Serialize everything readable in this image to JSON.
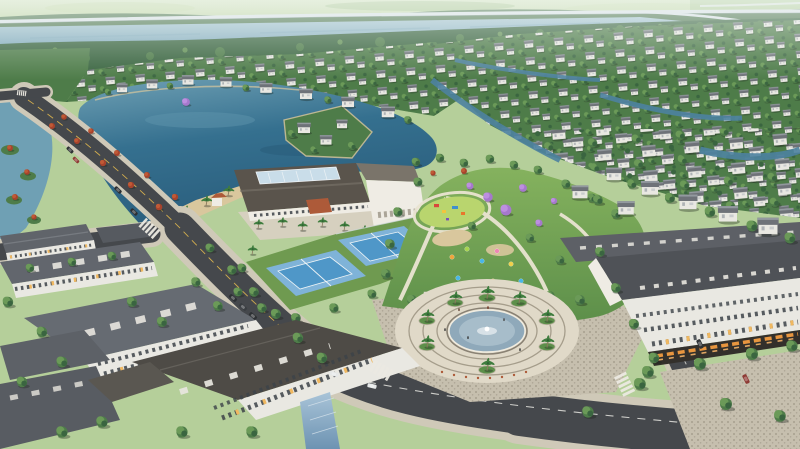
{
  "meta": {
    "type": "aerial-3d-render",
    "subject": "lakeside master-planned residential community, bird's-eye view",
    "width_px": 800,
    "height_px": 449
  },
  "scene": {
    "landmarks": [
      {
        "name": "river-and-elevated-highway",
        "position": "top edge"
      },
      {
        "name": "villa-field",
        "position": "upper half, white villas with grey roofs among trees and canals"
      },
      {
        "name": "central-lake",
        "position": "upper left-center, deep teal water"
      },
      {
        "name": "causeway-road",
        "position": "diagonal from top-left, lined with red flame trees"
      },
      {
        "name": "clubhouse",
        "position": "center, long white building with dark roof and glass skylight"
      },
      {
        "name": "tennis-courts",
        "count": 2,
        "position": "below clubhouse, blue courts on green apron"
      },
      {
        "name": "central-park",
        "position": "center-right, lawns, playground, purple jacaranda trees, balloons"
      },
      {
        "name": "fountain-plaza",
        "position": "lower center, circular paved plaza with fountain pool and palms"
      },
      {
        "name": "townhouse-blocks",
        "position": "lower left foreground, white facades, slate roofs, lit windows"
      },
      {
        "name": "shophouse-row",
        "position": "lower right, orange-lit storefronts"
      },
      {
        "name": "roads",
        "details": "asphalt streets with zebra crosswalks, lane dashes, cars"
      }
    ],
    "counts": {
      "tennis_courts": 2,
      "crosswalks": 4,
      "cars_visible": 11,
      "balloons": 10
    }
  },
  "palette": {
    "fieldLight": "#d8e6c0",
    "fieldMid": "#b2cd96",
    "fieldDark": "#9abc82",
    "bridge": "#dde4e9",
    "bridgeShadow": "#a8b6bf",
    "riverTop": "#a8c6d2",
    "riverBottom": "#7fa9bb",
    "treeDark": "#3a6540",
    "treeMid": "#4e7c49",
    "treeLight": "#6b9a58",
    "palmGreen": "#3f7d3e",
    "trunk": "#8a7a5e",
    "lakeLight": "#6fa0b4",
    "lake": "#35708f",
    "lakeDeep": "#2a5d7c",
    "canal": "#4d82a0",
    "sand": "#d9c79d",
    "villaWall": "#e9e8e2",
    "villaRoof": "#6e7278",
    "villaRoofLight": "#9aa0a6",
    "road": "#45484c",
    "roadLight": "#54575b",
    "laneYellow": "#d2ad4e",
    "laneWhite": "#e6e6e0",
    "sidewalk": "#cfc9b8",
    "cobble": "#c6bfae",
    "cobbleDot": "#a69f8f",
    "lawnLight": "#85b25e",
    "lawnDark": "#5d8f4a",
    "playLawn": "#b9d56e",
    "courtBlue": "#4f97c8",
    "courtBlueLight": "#7fb3d8",
    "courtGreen": "#6f9a50",
    "courtLine": "#eef4f6",
    "clubRoof": "#5a544c",
    "clubRoofLight": "#7a746a",
    "skylight": "#c9dde9",
    "wallWhite": "#efece4",
    "terracotta": "#ad5a39",
    "slateRoof": "#62666d",
    "slateRoofDark": "#4e4b46",
    "roofTrim": "#e8e6df",
    "windowDark": "#3c4248",
    "windowLit": "#f0b860",
    "storefrontGlow": "#e8963f",
    "storeDark": "#33302b",
    "glass": "#7fa2bf",
    "plaza": "#e0d9c8",
    "plazaRing": "#a59d8b",
    "pool": "#a7bdca",
    "poolDeep": "#8fa9ba",
    "redTree": "#a8432c",
    "redTreeLight": "#c05a36",
    "purpleTree": "#a678cc",
    "purpleTreeLight": "#bd8fe0",
    "balloonOrange": "#f0a43c",
    "balloonGreen": "#a7d44e",
    "balloonBlue": "#49b6e8",
    "balloonPink": "#ef86b4",
    "balloonYellow": "#f0d04a",
    "carDark": "#2e3134",
    "carWhite": "#e6e8e8",
    "carRed": "#8e3a34",
    "shadow": "rgba(25,35,25,0.35)"
  }
}
